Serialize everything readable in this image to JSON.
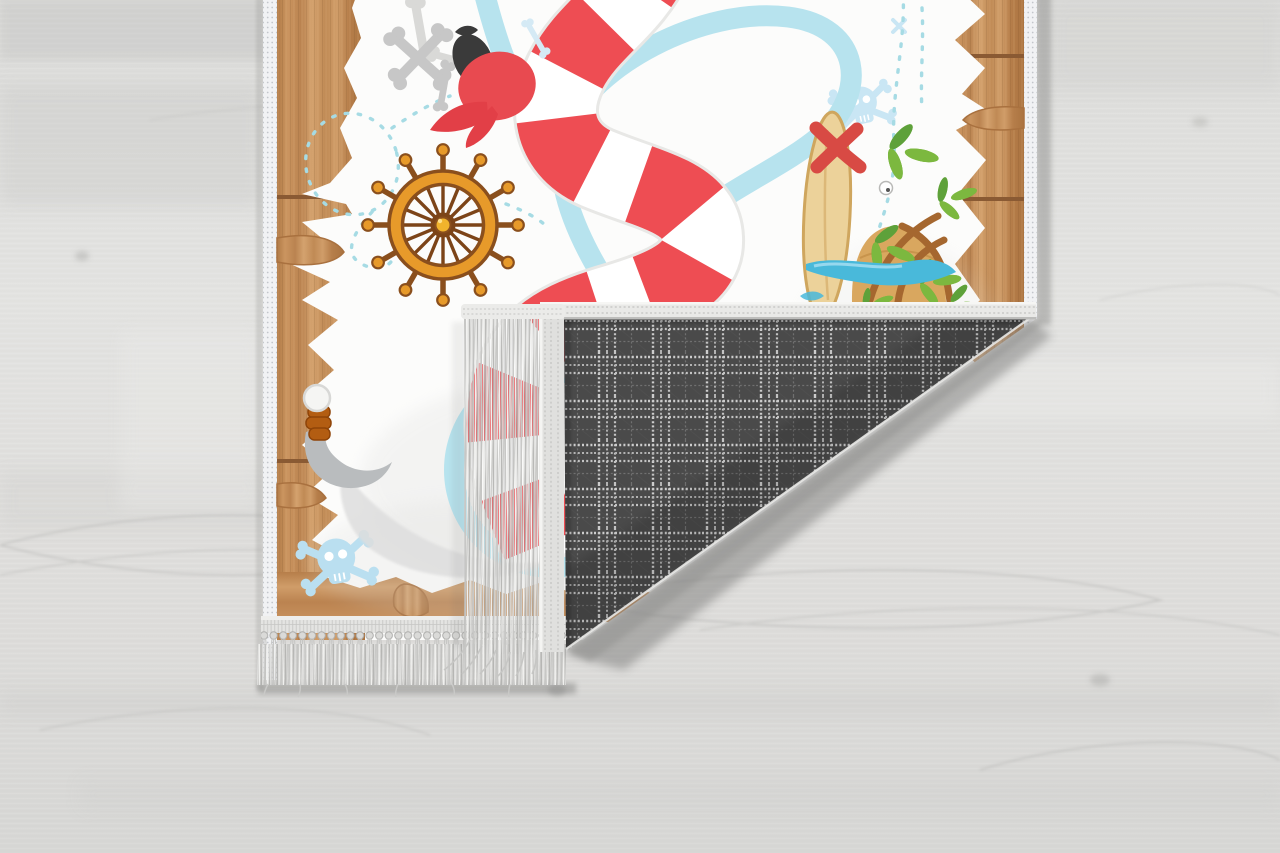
{
  "scene": {
    "alt": "Product photo: kids pirate treasure-map rug lying on a light gray wooden floor, bottom-right corner folded over showing the dark gray plaid woven backing, gray tassel fringe along the edges",
    "subject": "pirate-map-kids-rug",
    "setting": "light-gray-wood-floor"
  },
  "colors": {
    "floor": "#e0e0de",
    "floorGrain": "#c6c6c4",
    "mapGround": "#fcfcfb",
    "binding": "#f1f2f4",
    "bindingStitch": "#c3c6cb",
    "wood": "#c08a55",
    "woodLight": "#d8a877",
    "woodDark": "#8a5a33",
    "roadRed": "#ee4d53",
    "river": "#b7e3ee",
    "dashTrail": "#a6dbe4",
    "wheelOrange": "#e79a2a",
    "wheelBrown": "#8a4f1d",
    "hubGold": "#f1b32c",
    "boneGray": "#c7c7c7",
    "parrotRed": "#e84a50",
    "parrotBlack": "#3a3a3a",
    "watermarkBlue": "#c9e6f4",
    "palmGreen": "#7cb83f",
    "palmDark": "#5ea13a",
    "trunkBrown": "#a5672f",
    "sand": "#d9a75f",
    "board": "#ecd29a",
    "boardEdge": "#cfa65e",
    "xRed": "#d84a44",
    "water": "#49b9da",
    "hookGray": "#b9bcbe",
    "handleBrown": "#b35d12",
    "plaidBase": "#4e4e4e",
    "plaidLight": "#d8d8d8",
    "plaidMid": "#bdbdbd",
    "fringe": "#cfcfcd",
    "bandGray": "#e2e2e0",
    "shadow": "#8e8e8c"
  },
  "parts": {
    "floor": "wood-floor",
    "rug": "pirate-map-rug-front",
    "fold": "folded-corner-plaid-back",
    "fringe": "gray-tassel-fringe",
    "motifs": [
      "crossed-bones",
      "pirate-bandana",
      "ship-wheel",
      "dashed-treasure-trail",
      "red-white-striped-path",
      "blue-river",
      "palm-island",
      "x-marks-the-spot",
      "skull-watermark",
      "pirate-hook"
    ]
  }
}
